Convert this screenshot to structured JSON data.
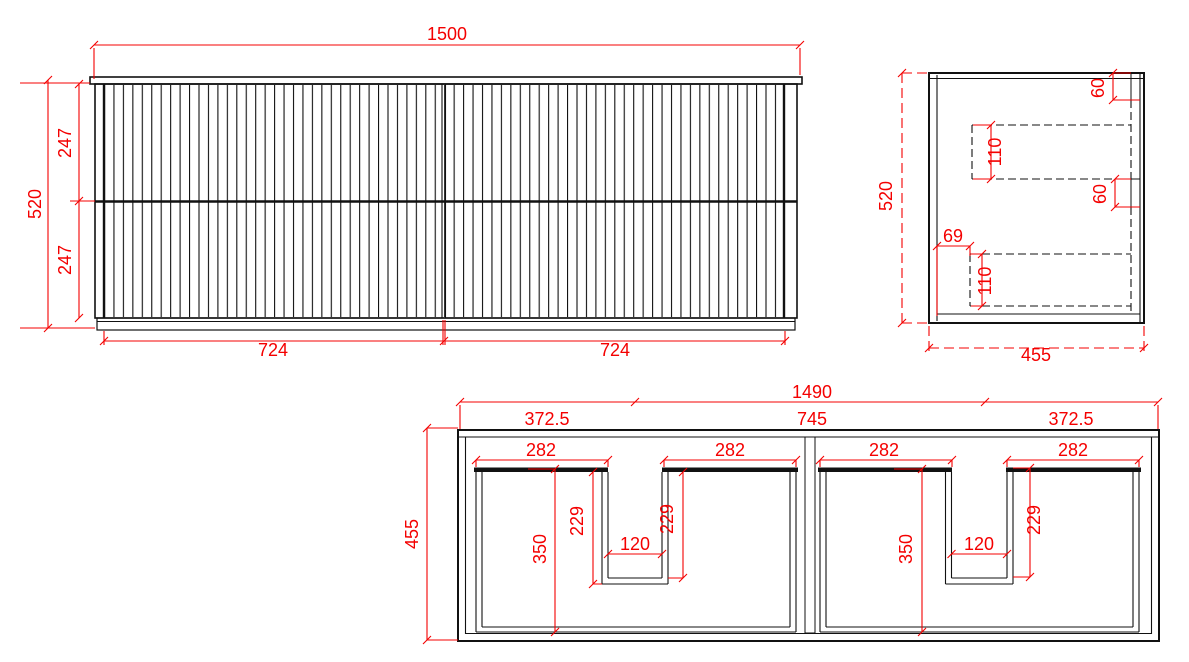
{
  "colors": {
    "line": "#111111",
    "dimension": "#f40000",
    "background": "#ffffff"
  },
  "front_view": {
    "overall_width": "1500",
    "overall_height": "520",
    "upper_drawer_height": "247",
    "lower_drawer_height": "247",
    "left_door_width": "724",
    "right_door_width": "724"
  },
  "side_view": {
    "overall_height": "520",
    "overall_depth": "455",
    "top_rail_height": "60",
    "upper_drawer_side_height": "110",
    "mid_rail_height": "60",
    "drawer_back_offset": "69",
    "lower_drawer_side_height": "110"
  },
  "plan_view": {
    "overall_width": "1490",
    "left_section": "372.5",
    "middle_section": "745",
    "right_section": "372.5",
    "overall_depth": "455",
    "shelf_width": "282",
    "notch_depth": "229",
    "notch_width": "120",
    "drawer_depth": "350"
  }
}
